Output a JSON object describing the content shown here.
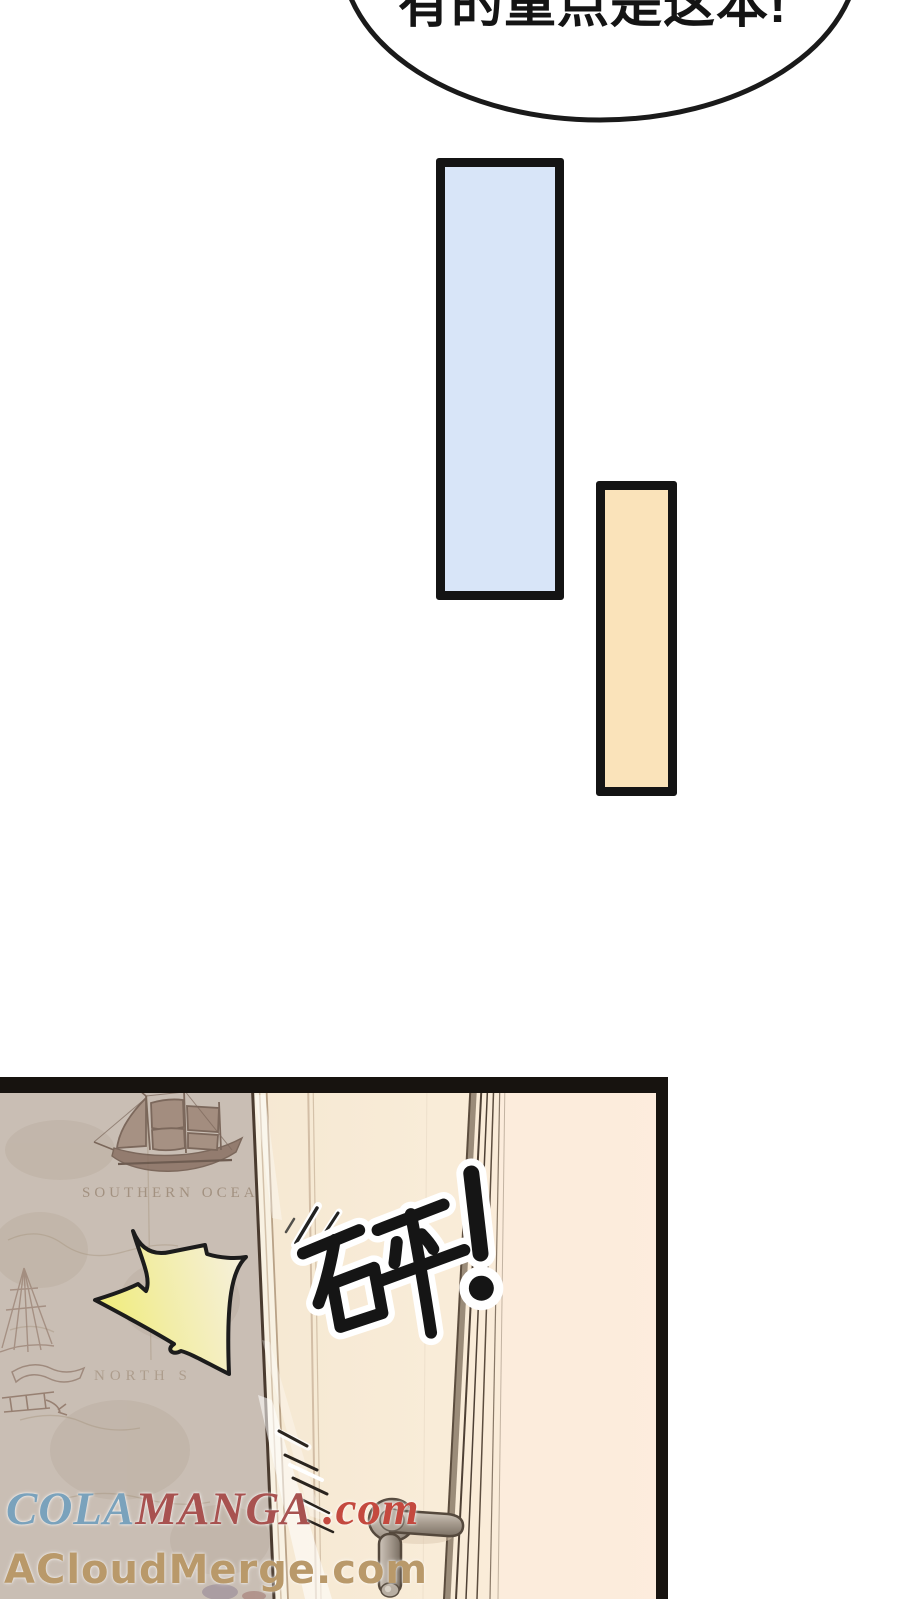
{
  "page": {
    "background": "#ffffff"
  },
  "speech_bubble": {
    "text": "有的重点是这本!"
  },
  "color_bars": {
    "blue": {
      "fill": "#d8e5f8",
      "border": "#141414"
    },
    "orange": {
      "fill": "#fae3ba",
      "border": "#141414"
    }
  },
  "panel": {
    "border_color": "#17130f",
    "sfx": {
      "text": "砰!"
    },
    "map": {
      "base_color": "#c9beb4",
      "labels": [
        {
          "text": "SOUTHERN OCEAN"
        },
        {
          "text": "NORTH S"
        }
      ]
    },
    "door": {
      "base_color": "#f8ecd8",
      "frame_line_color": "#55463a"
    },
    "handle_color": "#a1968a",
    "burst": {
      "fill_from": "#f0ed75",
      "fill_to": "#f6f0dc",
      "outline": "#1c1c1c"
    }
  },
  "watermarks": {
    "colamanga": {
      "part1": "COLA",
      "part1_color": "#7aa2bc",
      "part2": "MANGA",
      "part2_color": "#a85250",
      "part3": " .com",
      "part3_color": "#c4493f"
    },
    "acloudmerge": {
      "text": "ACloudMerge.com",
      "color": "#b9996a"
    }
  }
}
